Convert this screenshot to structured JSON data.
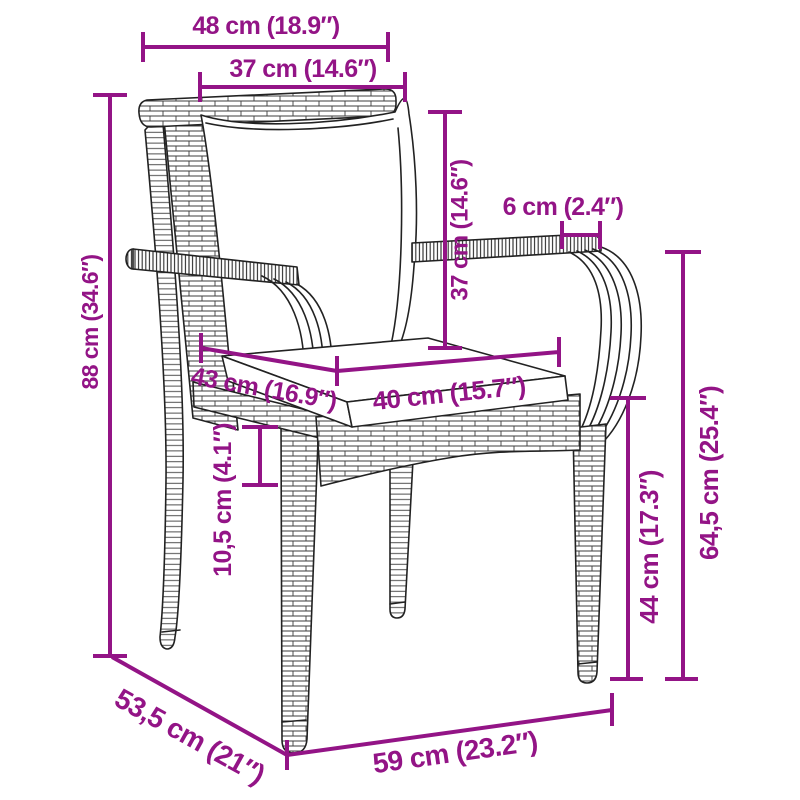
{
  "diagram": {
    "type": "product-dimension-diagram",
    "subject": "Poly rattan garden chair with back and seat cushions",
    "accent_color": "#931486",
    "outline_color": "#222222",
    "background_color": "#ffffff",
    "dimensions": [
      {
        "id": "backrest-top-outer-width",
        "label": "48 cm (18.9″)"
      },
      {
        "id": "backrest-top-inner-width",
        "label": "37 cm (14.6″)"
      },
      {
        "id": "armrest-width",
        "label": "6 cm (2.4″)"
      },
      {
        "id": "backrest-height",
        "label": "37 cm (14.6″)"
      },
      {
        "id": "total-height",
        "label": "88 cm (34.6″)"
      },
      {
        "id": "seat-depth",
        "label": "43 cm (16.9″)"
      },
      {
        "id": "seat-width",
        "label": "40 cm (15.7″)"
      },
      {
        "id": "seat-frame-height",
        "label": "10,5 cm (4.1″)"
      },
      {
        "id": "seat-height",
        "label": "44 cm (17.3″)"
      },
      {
        "id": "armrest-height",
        "label": "64,5 cm (25.4″)"
      },
      {
        "id": "base-depth",
        "label": "53,5 cm (21″)"
      },
      {
        "id": "base-width",
        "label": "59 cm (23.2″)"
      }
    ]
  }
}
